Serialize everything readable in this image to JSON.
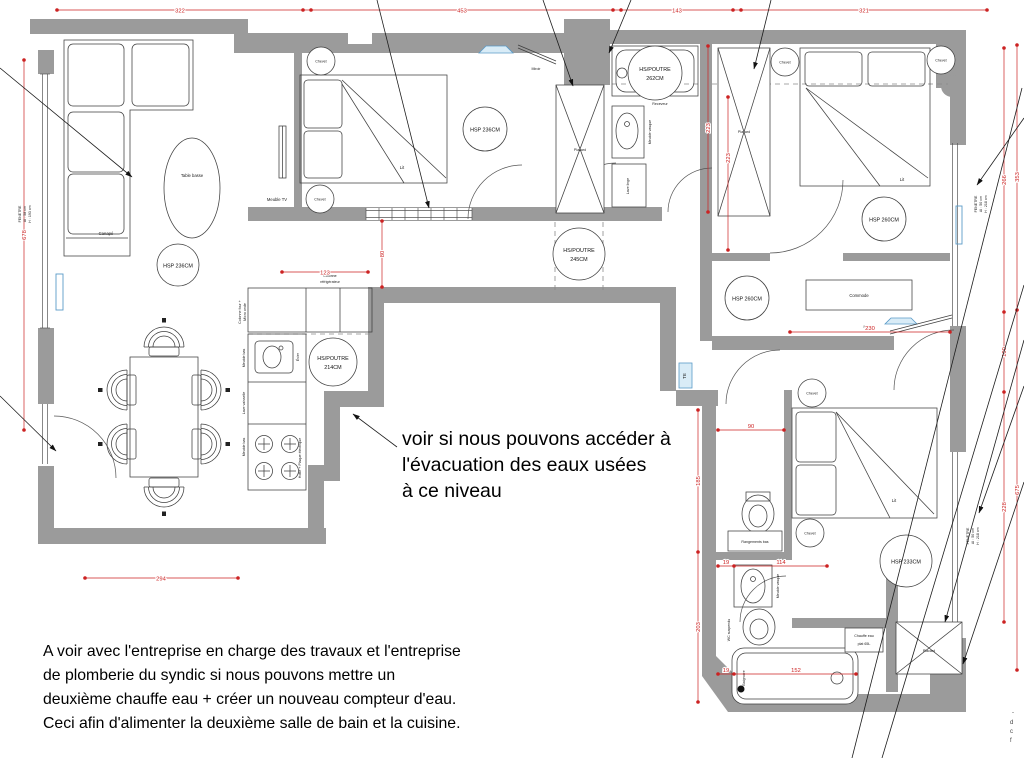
{
  "plan": {
    "labels": {
      "canape": "Canapé",
      "table_basse": "Table basse",
      "meuble_tv": "Meuble TV",
      "chevet": "Chevet",
      "lit": "Lit",
      "placard": "Placard",
      "miroir": "Miroir",
      "receveur": "Receveur",
      "meuble_vasque": "Meuble vasque",
      "lave_linge": "Lave linge",
      "commode": "Commode",
      "wc_suspendu": "WC suspendu",
      "rangements_bas": "Rangements bas",
      "baignoire": "Baignoire",
      "chauffe_eau_1": "Chauffe eau",
      "chauffe_eau_2": "plat 65L",
      "te": "TE",
      "colonne_four_1": "Colonne four +",
      "colonne_four_2": "Micro onde",
      "meuble_bas": "Meuble bas",
      "lave_vaisselle": "Lave vaisselle",
      "evier": "Évier",
      "hotte": "Hotte + Plaque électrique",
      "colonne_refrig_1": "Colonne",
      "colonne_refrig_2": "réfrigérateur"
    },
    "heights": {
      "hsp236": "HSP 236CM",
      "hsp260": "HSP 260CM",
      "hsp233": "HSP 233CM",
      "poutre262_1": "HS/POUTRE",
      "poutre262_2": "262CM",
      "poutre245_1": "HS/POUTRE",
      "poutre245_2": "245CM",
      "poutre214_1": "HS/POUTRE",
      "poutre214_2": "214CM"
    },
    "dims": {
      "d322": "322",
      "d453": "453",
      "d143": "143",
      "d321": "321",
      "d678": "678",
      "d294": "294",
      "d123": "123",
      "d80": "80",
      "d223": "223",
      "d266": "266",
      "d353": "353",
      "d100": "100",
      "d228": "228",
      "d675": "675",
      "d230": "230",
      "d90": "90",
      "d185": "185",
      "d203": "203",
      "d19": "19",
      "d114": "114",
      "d152": "152"
    },
    "windows": {
      "left_1": "FENETRE",
      "left_2": "AI : 58 cm",
      "left_3": "H : 193 cm",
      "right1_1": "FENETRE",
      "right1_2": "AI : 50 cm",
      "right1_3": "H : 218 cm",
      "right2_1": "FENETRE",
      "right2_2": "AI : 50 cm",
      "right2_3": "H : 218 cm"
    },
    "notes": {
      "mid_1": "voir si nous pouvons accéder à",
      "mid_2": "l'évacuation des eaux usées",
      "mid_3": "à ce niveau",
      "bottom_1": "A voir avec l'entreprise en charge des travaux et l'entreprise",
      "bottom_2": "de plomberie du syndic si nous pouvons mettre un",
      "bottom_3": "deuxième chauffe eau + créer un nouveau compteur d'eau.",
      "bottom_4": "Ceci afin d'alimenter la deuxième salle de bain et la cuisine.",
      "fragment_1": "-",
      "fragment_2": "d",
      "fragment_3": "c",
      "fragment_4": "f"
    },
    "colors": {
      "wall": "#9b9b9b",
      "dimension": "#cc2222",
      "accent_blue": "#5b9bc8",
      "line": "#3f3f3f"
    }
  }
}
